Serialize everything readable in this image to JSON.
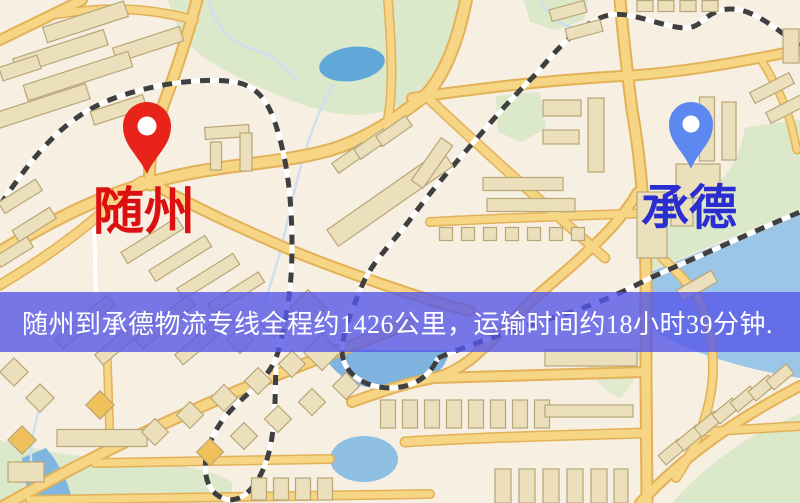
{
  "banner": {
    "text": "随州到承德物流专线全程约1426公里，运输时间约18小时39分钟."
  },
  "markers": {
    "origin": {
      "label": "随州",
      "pin_color": "#e8231a",
      "label_color": "#dc1010"
    },
    "destination": {
      "label": "承德",
      "pin_color": "#5d88ef",
      "label_color": "#2a2ed1"
    }
  },
  "palette": {
    "background": "#f7efe2",
    "road_fill": "#f6d584",
    "road_casing": "#e3b158",
    "park": "#dbe8c9",
    "water": "#8fc0e4",
    "lake": "#60a8d8",
    "railway": "#3f3f3f",
    "building": "#ece0bc",
    "banner_background": "#5658e8",
    "banner_text": "#ffffff"
  }
}
